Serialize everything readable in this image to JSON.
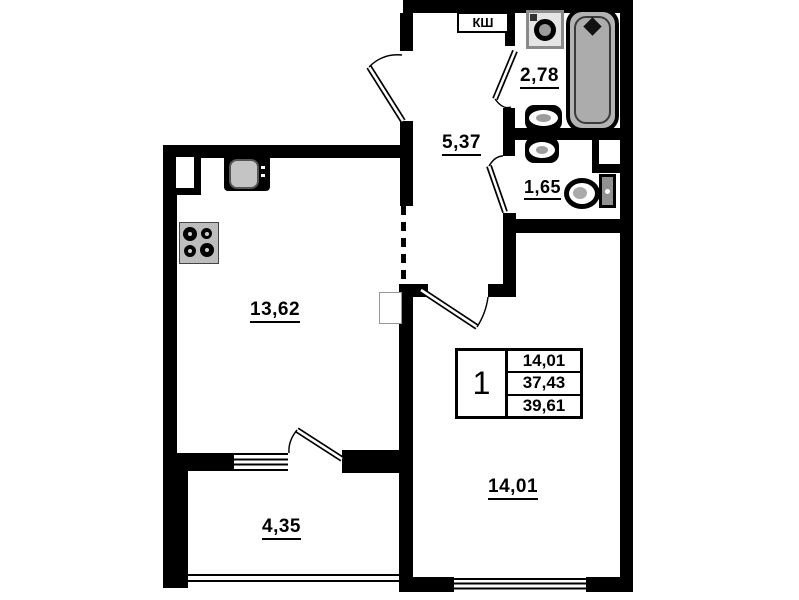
{
  "rooms": {
    "kitchen": {
      "area": "13,62"
    },
    "hallway": {
      "area": "5,37"
    },
    "bathroom": {
      "area": "2,78"
    },
    "toilet": {
      "area": "1,65"
    },
    "living_room": {
      "area": "14,01"
    },
    "balcony": {
      "area": "4,35"
    }
  },
  "labels": {
    "closet_shaft": "КШ"
  },
  "unit_info": {
    "rooms_count": "1",
    "living_area": "14,01",
    "area_without_balcony": "37,43",
    "total_area": "39,61"
  },
  "colors": {
    "walls": "#000000",
    "background": "#ffffff",
    "bathtub_fill": "#b3b3b3",
    "appliance_fill": "#bdbdbd"
  }
}
